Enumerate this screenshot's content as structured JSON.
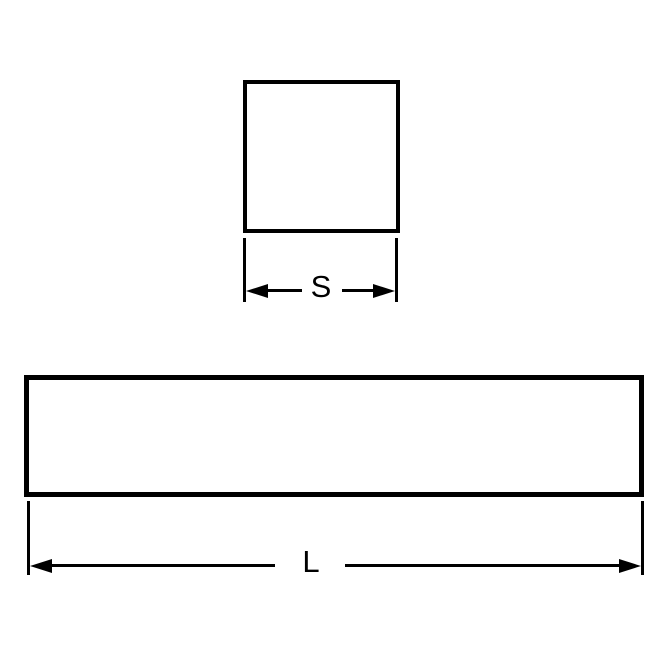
{
  "colors": {
    "line": "#000000",
    "background": "#ffffff"
  },
  "drawing": {
    "description": "",
    "square_dimension_label": "S",
    "length_dimension_label": "L"
  }
}
